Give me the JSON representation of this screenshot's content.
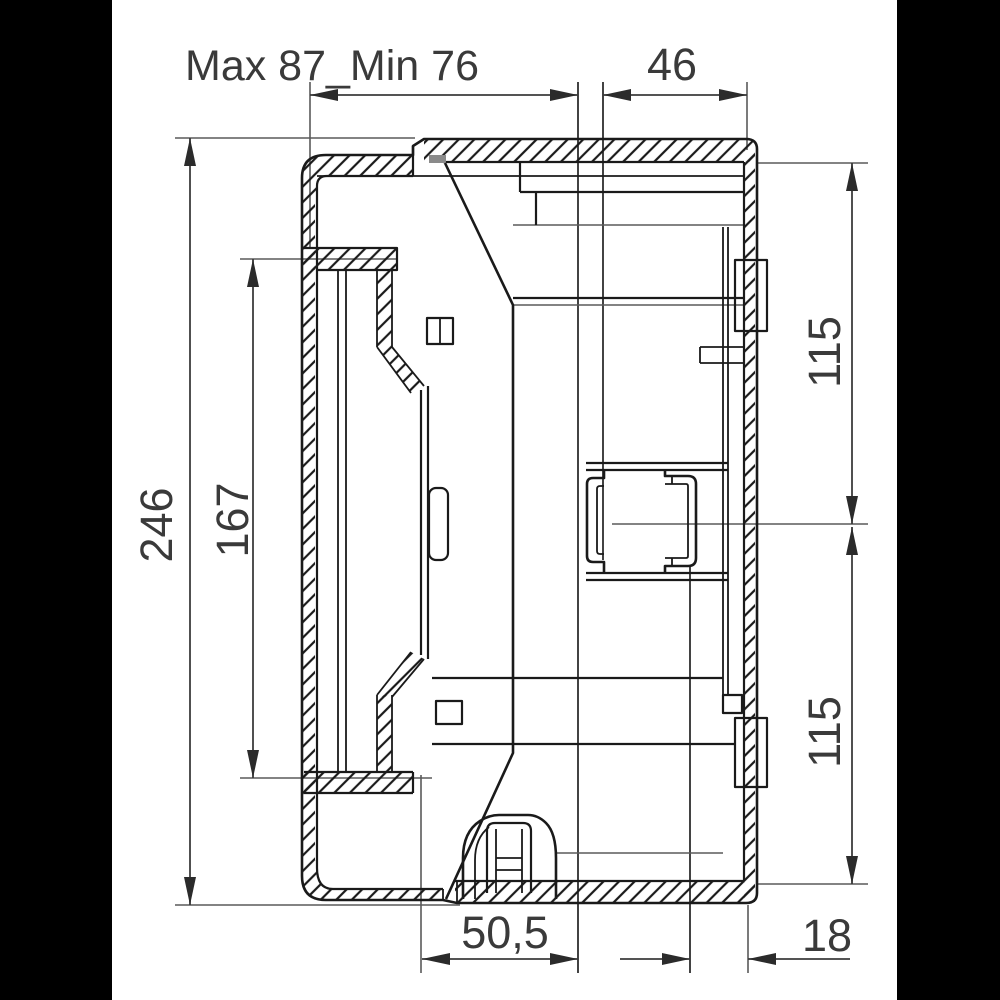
{
  "drawing": {
    "type": "technical-section-drawing",
    "dimensions": {
      "top_span": "Max 87_Min 76",
      "top_right_span": "46",
      "left_overall_height": "246",
      "left_opening_height": "167",
      "right_upper_spacing": "115",
      "right_lower_spacing": "115",
      "bottom_span": "50,5",
      "bottom_right_span": "18"
    },
    "colors": {
      "background": "#ffffff",
      "letterbox": "#000000",
      "object_line": "#1a1a1a",
      "dimension_line": "#3c3c3c",
      "text": "#3a3a3a"
    }
  }
}
